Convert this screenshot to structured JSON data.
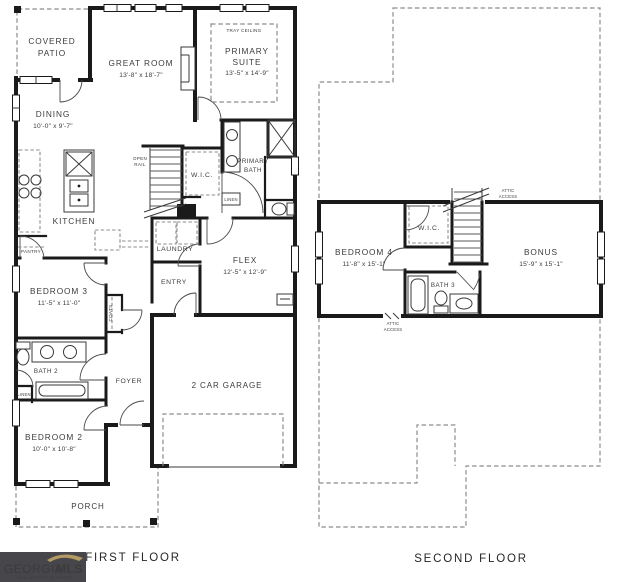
{
  "colors": {
    "wall": "#1a1a1a",
    "dashed_line": "#8c8c8c",
    "label_text": "#3c3c3c",
    "logo_background": "#46464b",
    "logo_gold": "#b39a64",
    "logo_white": "#ffffff"
  },
  "first_floor": {
    "caption": "FIRST FLOOR",
    "covered_patio": {
      "line1": "COVERED",
      "line2": "PATIO"
    },
    "great_room": {
      "name": "GREAT ROOM",
      "dims": "13'-8\" x 18'-7\""
    },
    "primary_suite": {
      "tray": "TRAY CEILING",
      "line1": "PRIMARY",
      "line2": "SUITE",
      "dims": "13'-5\" x 14'-9\""
    },
    "dining": {
      "name": "DINING",
      "dims": "10'-0\" x 9'-7\""
    },
    "kitchen": {
      "name": "KITCHEN"
    },
    "pantry": {
      "name": "PANTRY"
    },
    "open_rail": {
      "line1": "OPEN",
      "line2": "RAIL"
    },
    "wic": {
      "name": "W.I.C."
    },
    "primary_bath": {
      "line1": "PRIMARY",
      "line2": "BATH"
    },
    "linen": {
      "name": "LINEN"
    },
    "laundry": {
      "name": "LAUNDRY"
    },
    "entry": {
      "name": "ENTRY"
    },
    "flex": {
      "name": "FLEX",
      "dims": "12'-5\" x 12'-9\""
    },
    "coats": {
      "name": "COATS"
    },
    "bedroom3": {
      "name": "BEDROOM 3",
      "dims": "11'-5\" x 11'-0\""
    },
    "bath2": {
      "name": "BATH 2"
    },
    "linen2": {
      "name": "LINEN"
    },
    "foyer": {
      "name": "FOYER"
    },
    "bedroom2": {
      "name": "BEDROOM 2",
      "dims": "10'-0\" x 10'-8\""
    },
    "garage": {
      "name": "2 CAR GARAGE"
    },
    "porch": {
      "name": "PORCH"
    }
  },
  "second_floor": {
    "caption": "SECOND FLOOR",
    "attic_access_top": {
      "line1": "ATTIC",
      "line2": "ACCESS"
    },
    "wic": {
      "name": "W.I.C."
    },
    "bedroom4": {
      "name": "BEDROOM 4",
      "dims": "11'-8\" x 15'-1\""
    },
    "bonus": {
      "name": "BONUS",
      "dims": "15'-9\" x 15'-1\""
    },
    "bath3": {
      "name": "BATH 3"
    },
    "attic_access_bottom": {
      "line1": "ATTIC",
      "line2": "ACCESS"
    }
  },
  "logo": {
    "brand_primary": "GEORGIA",
    "brand_secondary": "MLS",
    "tagline": "REAL ESTATE SERVICES"
  }
}
